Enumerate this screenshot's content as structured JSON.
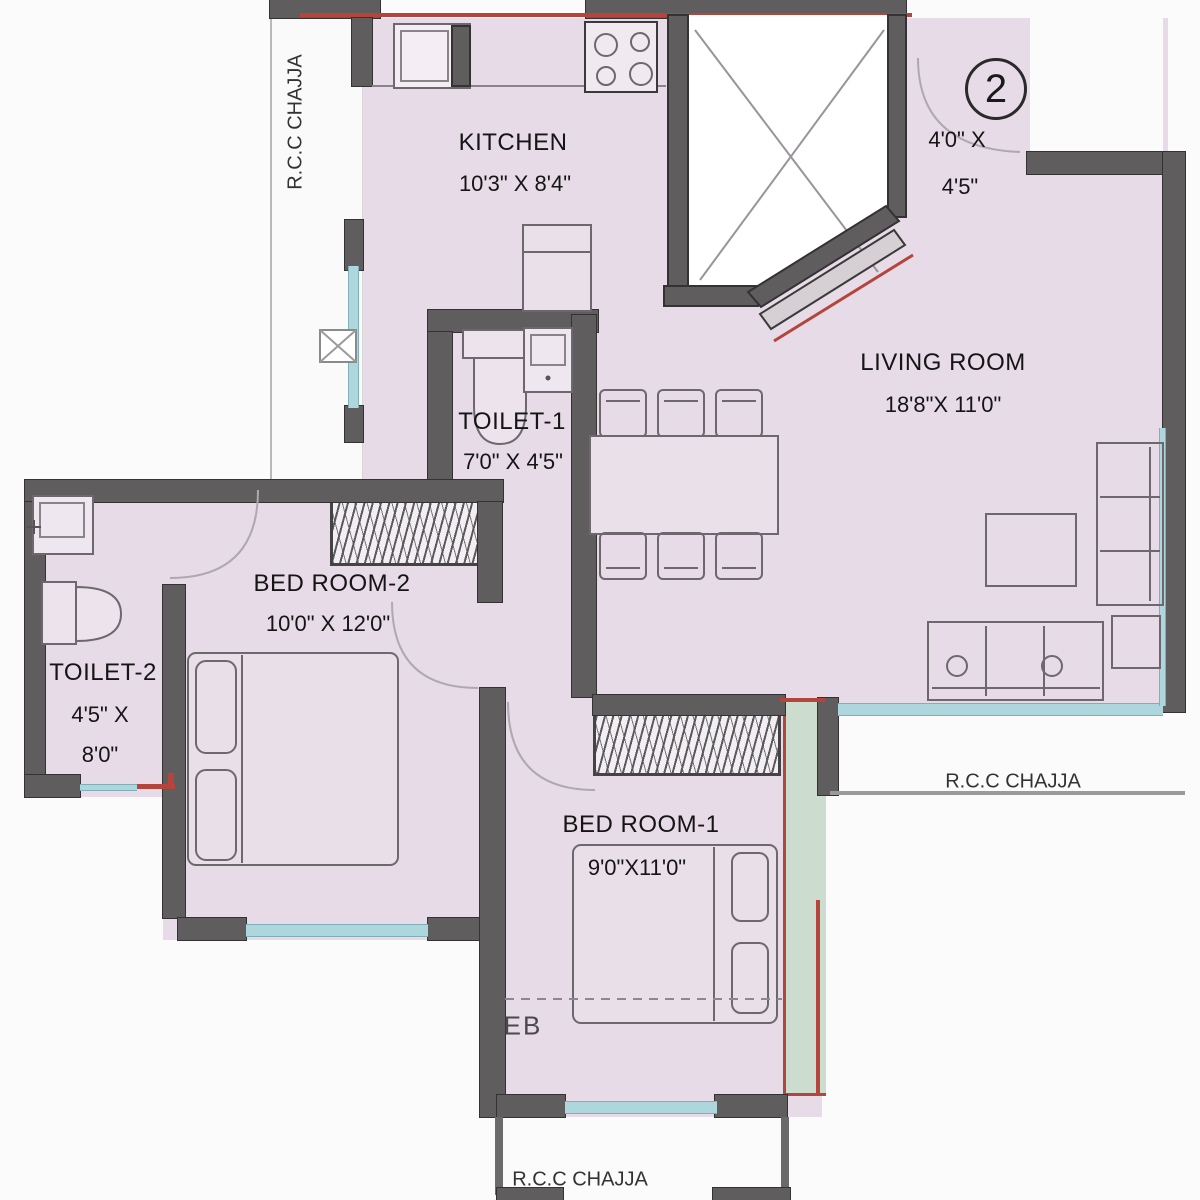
{
  "floorplan": {
    "unit_badge": "2",
    "rooms": {
      "kitchen": {
        "name": "KITCHEN",
        "dims": "10'3\" X 8'4\""
      },
      "living": {
        "name": "LIVING ROOM",
        "dims": "18'8\"X 11'0\""
      },
      "toilet1": {
        "name": "TOILET-1",
        "dims": "7'0\" X 4'5\""
      },
      "toilet2": {
        "name": "TOILET-2",
        "dims_line1": "4'5\" X",
        "dims_line2": "8'0\""
      },
      "bedroom2": {
        "name": "BED ROOM-2",
        "dims": "10'0\" X 12'0\""
      },
      "bedroom1": {
        "name": "BED ROOM-1",
        "dims": "9'0\"X11'0\""
      },
      "balcony": {
        "dims_line1": "4'0\" X",
        "dims_line2": "4'5\""
      }
    },
    "chajja_labels": {
      "left": "R.C.C CHAJJA",
      "right": "R.C.C CHAJJA",
      "bottom": "R.C.C CHAJJA"
    },
    "eb_label": "EB",
    "colors": {
      "floor": "#e6dbe6",
      "wall": "#5f5d5e",
      "window": "#aed7dd",
      "accent_red": "#b5453c",
      "chajja_green": "#ccdcce"
    }
  }
}
